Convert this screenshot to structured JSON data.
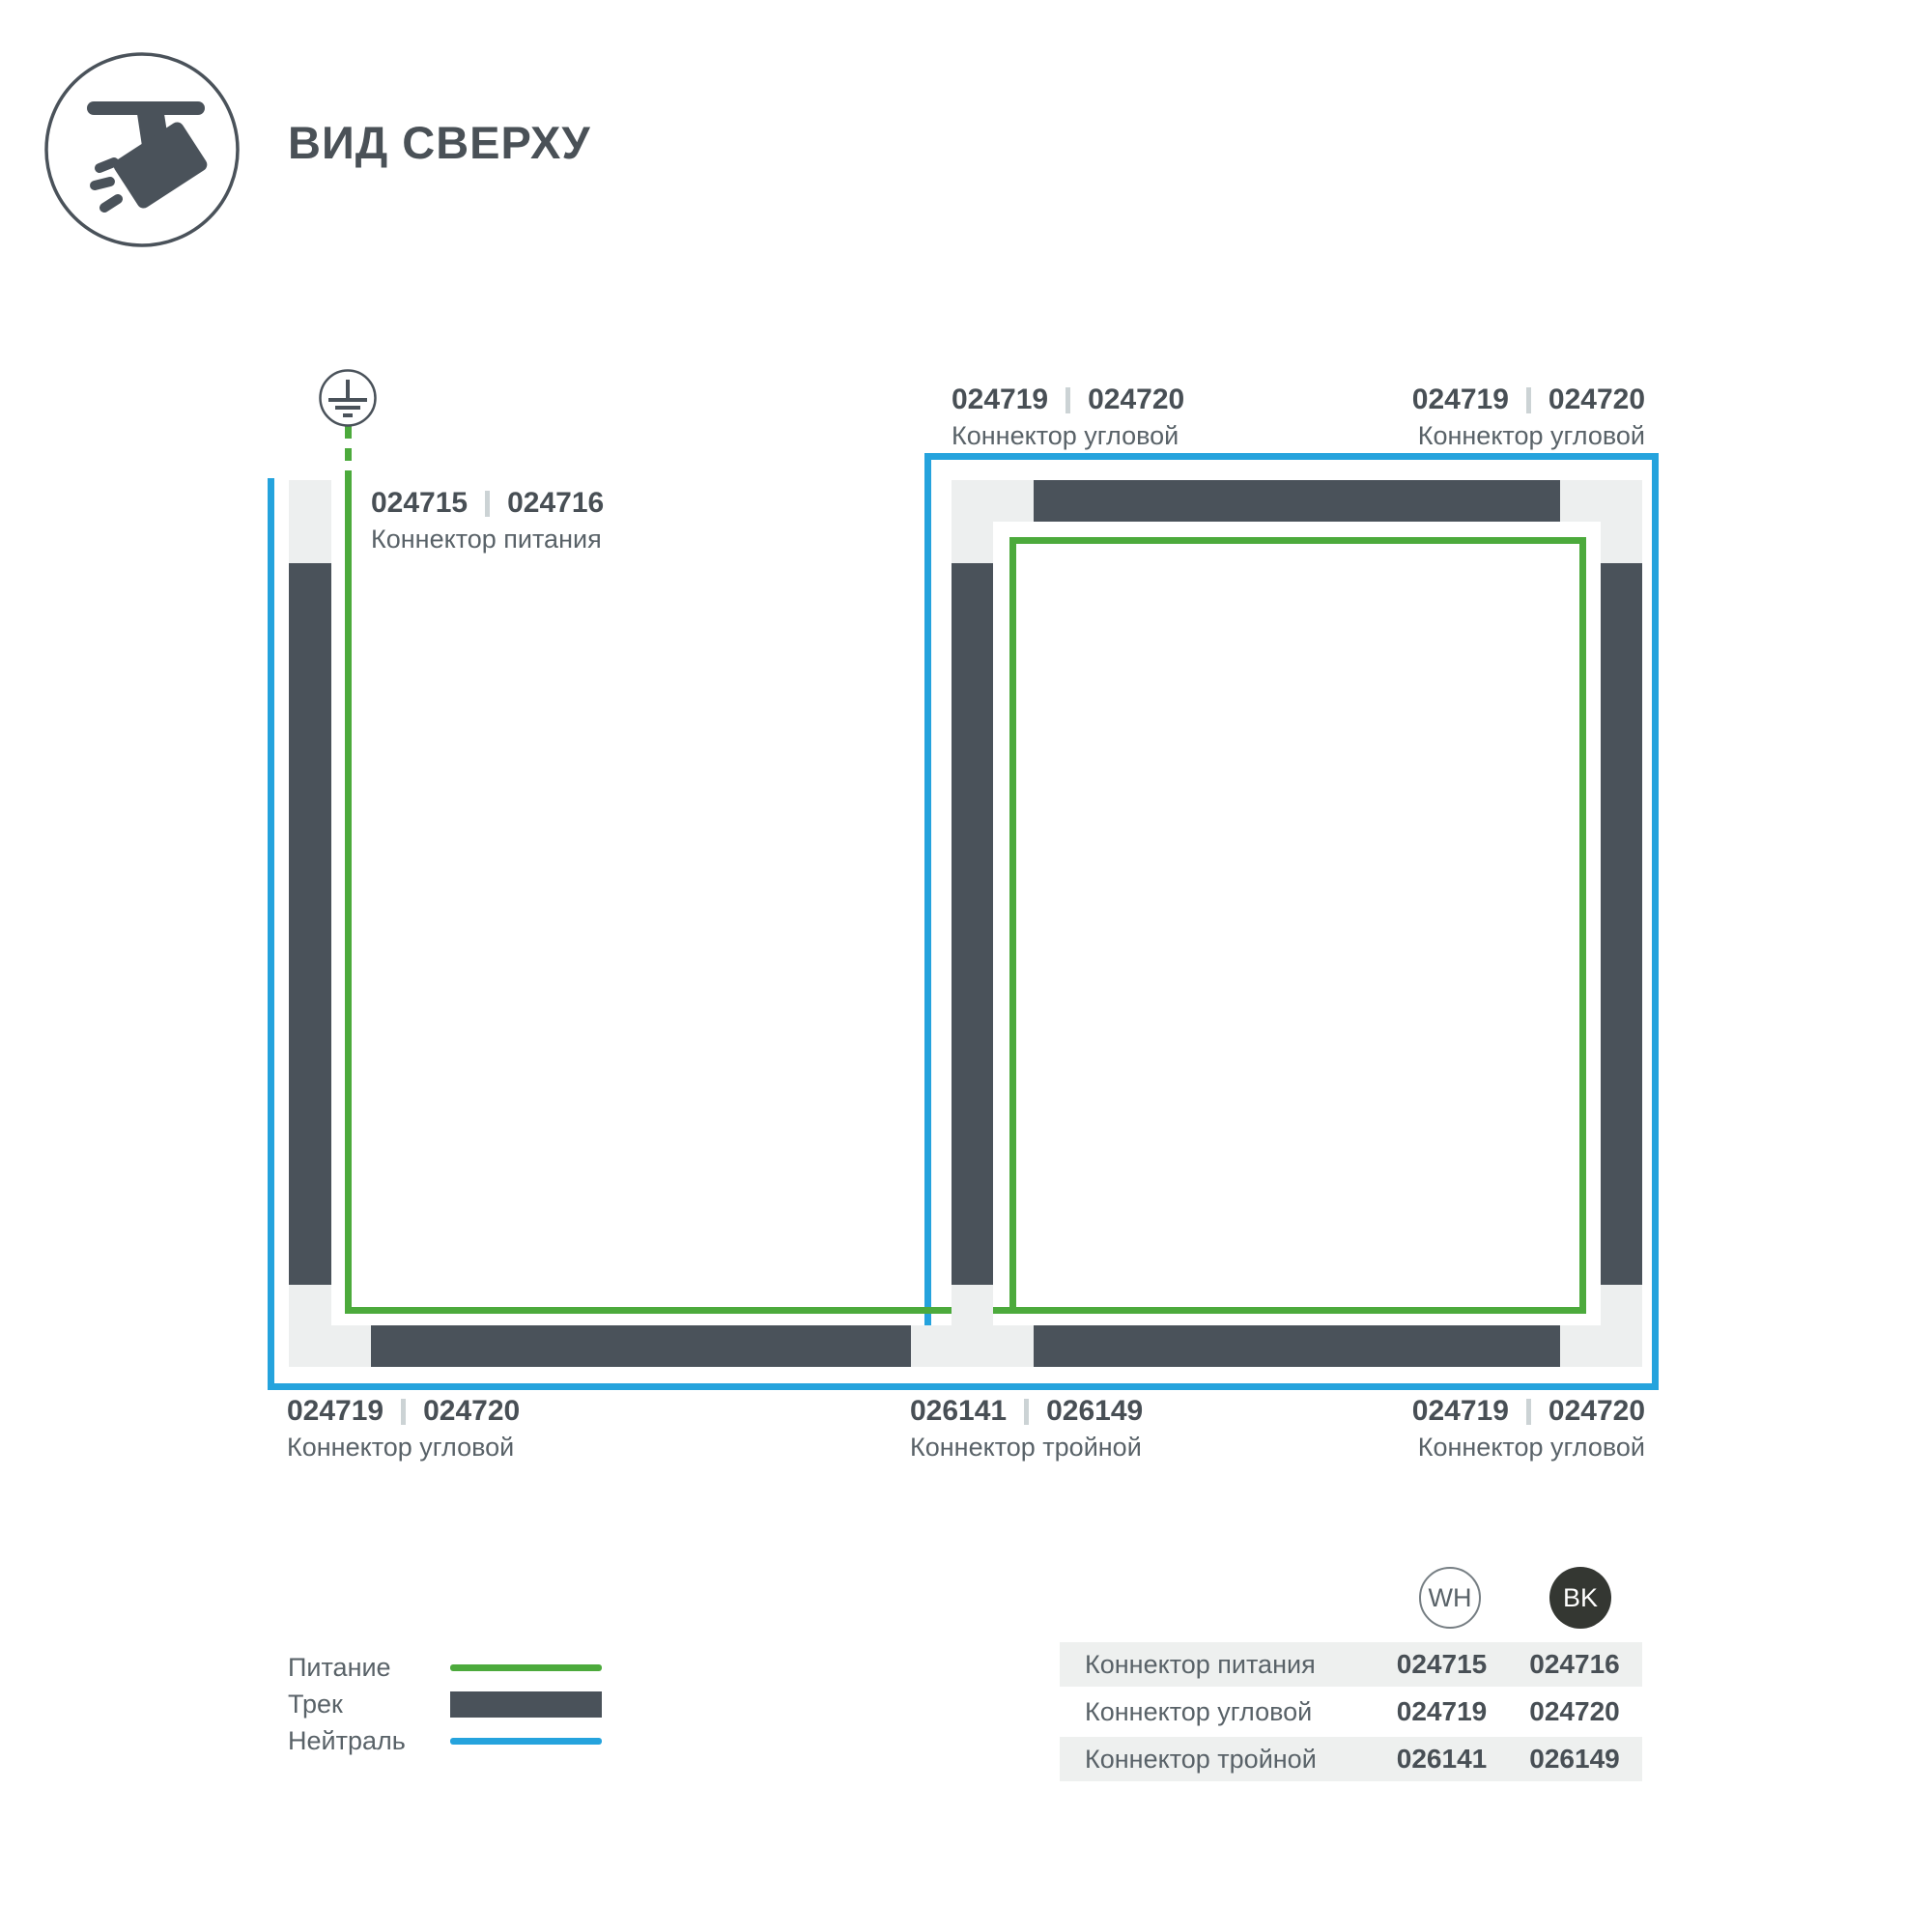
{
  "header": {
    "title": "ВИД СВЕРХУ"
  },
  "colors": {
    "accent_green": "#4caa3c",
    "accent_blue": "#25a3dd",
    "track_dark": "#4a525a",
    "connector_light": "#edefef",
    "row_bg": "#eef0ef",
    "bk_fill": "#343732"
  },
  "labels": {
    "power": {
      "wh": "024715",
      "bk": "024716",
      "name": "Коннектор питания"
    },
    "corner_top_left": {
      "wh": "024719",
      "bk": "024720",
      "name": "Коннектор угловой"
    },
    "corner_top_right": {
      "wh": "024719",
      "bk": "024720",
      "name": "Коннектор угловой"
    },
    "corner_bottom_left": {
      "wh": "024719",
      "bk": "024720",
      "name": "Коннектор угловой"
    },
    "triple_bottom_mid": {
      "wh": "026141",
      "bk": "026149",
      "name": "Коннектор тройной"
    },
    "corner_bottom_right": {
      "wh": "024719",
      "bk": "024720",
      "name": "Коннектор угловой"
    }
  },
  "legend": {
    "items": [
      {
        "label": "Питание",
        "swatch": "power-line"
      },
      {
        "label": "Трек",
        "swatch": "track-bar"
      },
      {
        "label": "Нейтраль",
        "swatch": "neutral-line"
      }
    ]
  },
  "table": {
    "columns": [
      "WH",
      "BK"
    ],
    "rows": [
      {
        "name": "Коннектор питания",
        "wh": "024715",
        "bk": "024716"
      },
      {
        "name": "Коннектор угловой",
        "wh": "024719",
        "bk": "024720"
      },
      {
        "name": "Коннектор тройной",
        "wh": "026141",
        "bk": "026149"
      }
    ]
  }
}
